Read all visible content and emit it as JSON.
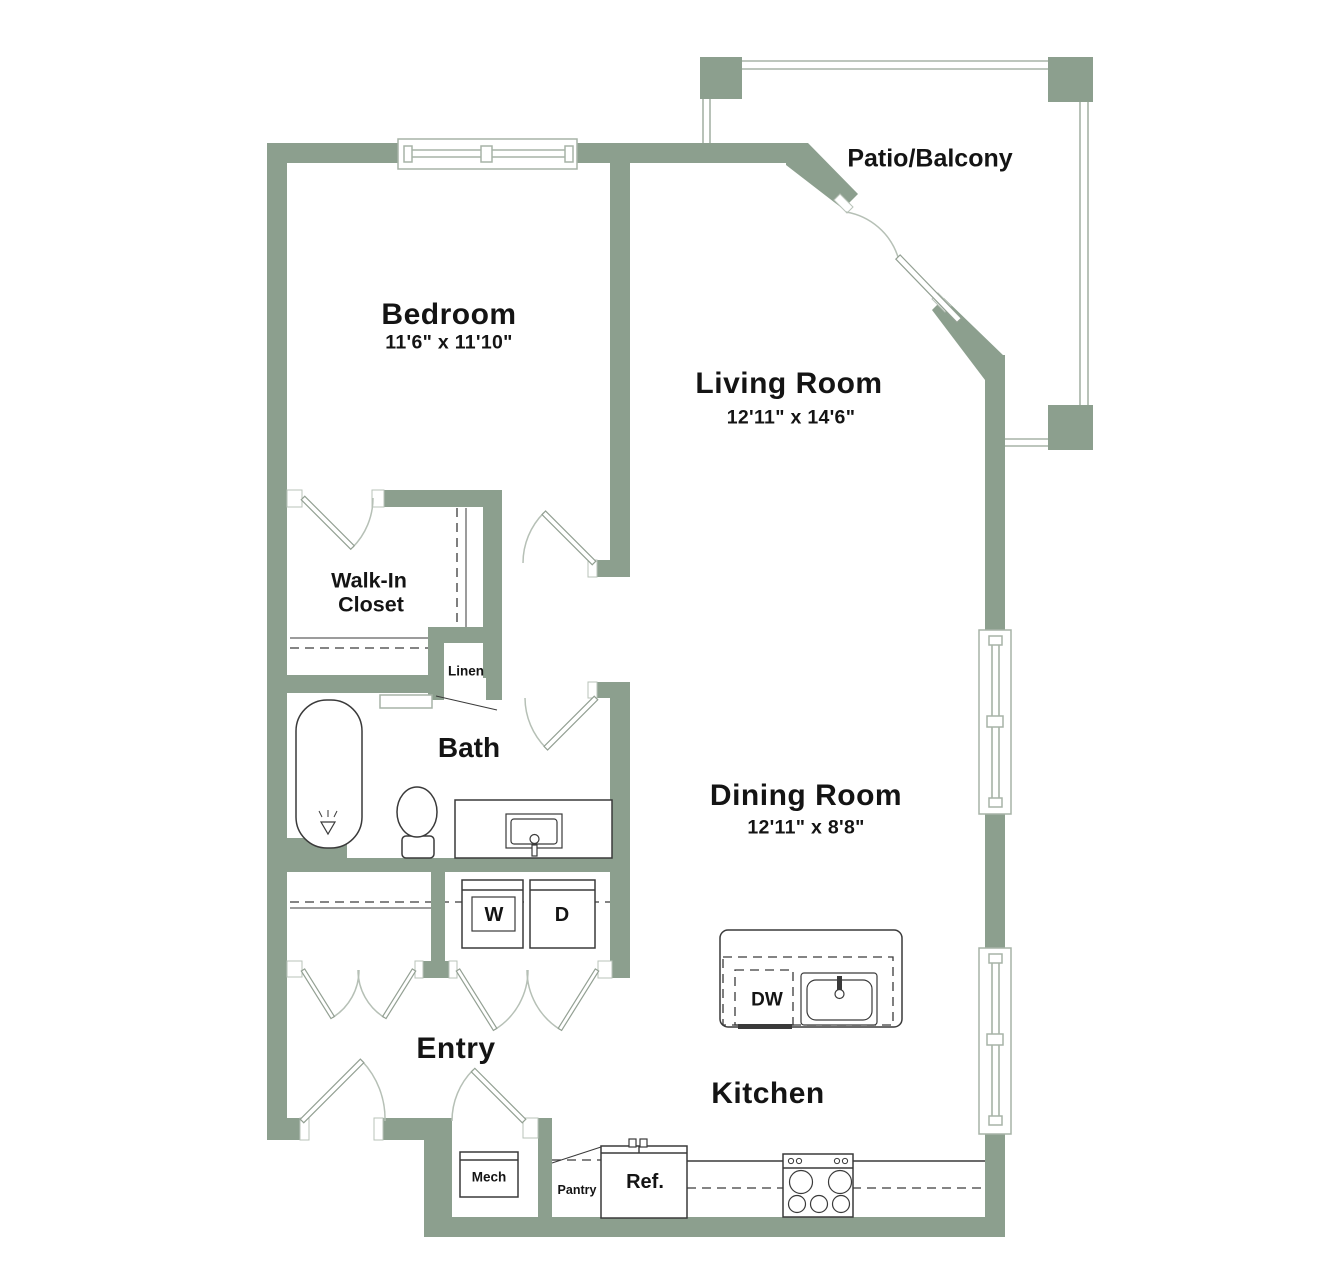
{
  "colors": {
    "wall": "#8c9f8e",
    "fixture": "#3a3a3a",
    "light": "#a7b3a7",
    "text": "#141414",
    "bg": "#ffffff"
  },
  "labels": {
    "patio": "Patio/Balcony",
    "bedroom": {
      "name": "Bedroom",
      "dims": "11'6\" x 11'10\""
    },
    "living": {
      "name": "Living Room",
      "dims": "12'11\" x 14'6\""
    },
    "dining": {
      "name": "Dining Room",
      "dims": "12'11\" x 8'8\""
    },
    "walkin": {
      "line1": "Walk-In",
      "line2": "Closet"
    },
    "linen": "Linen",
    "bath": "Bath",
    "entry": "Entry",
    "kitchen": "Kitchen",
    "washer": "W",
    "dryer": "D",
    "dishwasher": "DW",
    "mech": "Mech",
    "pantry": "Pantry",
    "fridge": "Ref."
  }
}
